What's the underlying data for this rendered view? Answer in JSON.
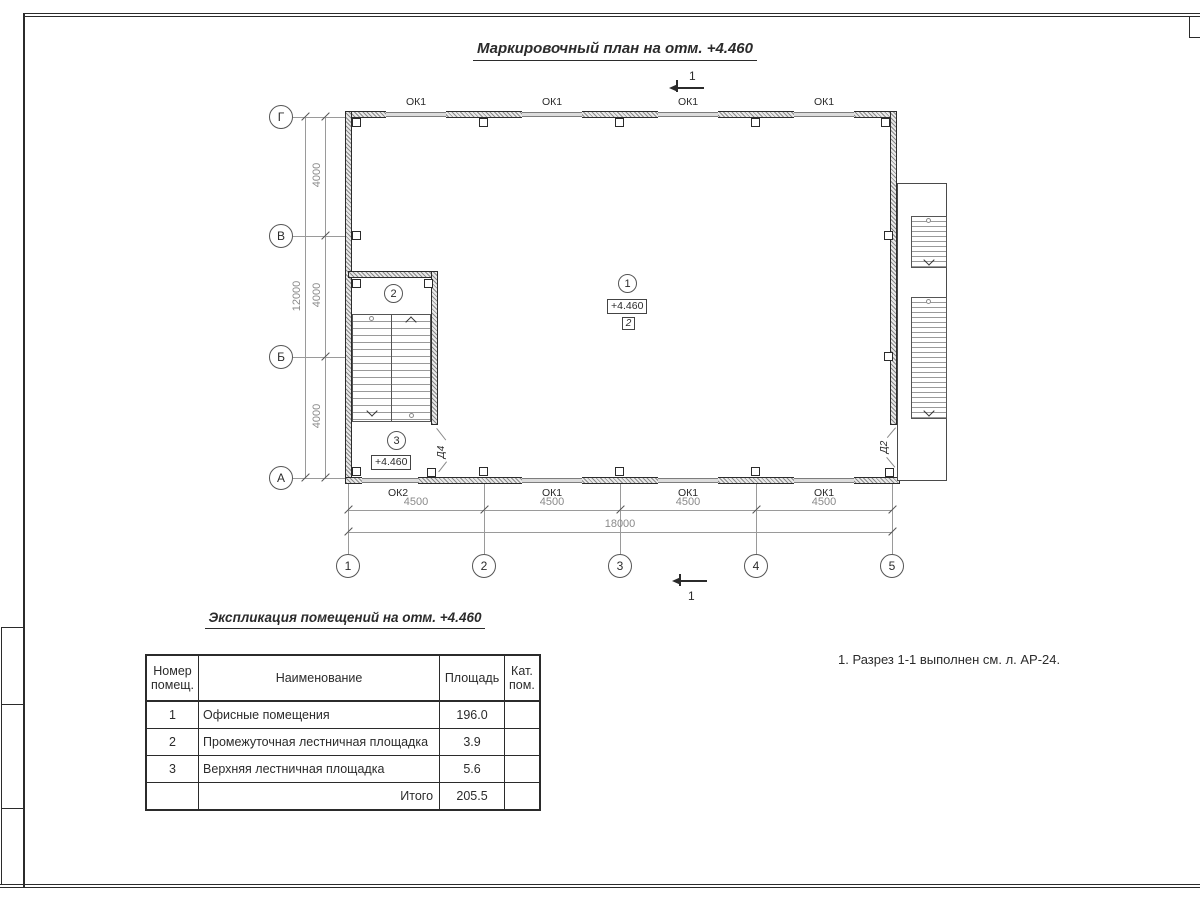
{
  "drawing": {
    "title": "Маркировочный план на отм. +4.460",
    "note": "1. Разрез 1-1 выполнен см. л. АР-24.",
    "section_mark": "1",
    "elevation_mark": "+4.460",
    "finish_mark": "2",
    "room_marks": [
      "1",
      "2",
      "3"
    ],
    "door_marks": {
      "d4": "Д4",
      "d2": "Д2"
    },
    "windows_top": [
      "ОК1",
      "ОК1",
      "ОК1",
      "ОК1"
    ],
    "windows_bottom": [
      "ОК2",
      "ОК1",
      "ОК1",
      "ОК1"
    ],
    "axes_rows": [
      "Г",
      "В",
      "Б",
      "А"
    ],
    "axes_cols": [
      "1",
      "2",
      "3",
      "4",
      "5"
    ],
    "dims_left_segments": [
      "4000",
      "4000",
      "4000"
    ],
    "dims_left_total": "12000",
    "dims_bottom_segments": [
      "4500",
      "4500",
      "4500",
      "4500"
    ],
    "dims_bottom_total": "18000"
  },
  "schedule": {
    "title": "Экспликация помещений на отм. +4.460",
    "headers": {
      "number": "Номер помещ.",
      "name": "Наименование",
      "area": "Площадь",
      "category": "Кат. пом."
    },
    "rows": [
      {
        "number": "1",
        "name": "Офисные помещения",
        "area": "196.0",
        "category": ""
      },
      {
        "number": "2",
        "name": "Промежуточная лестничная площадка",
        "area": "3.9",
        "category": ""
      },
      {
        "number": "3",
        "name": "Верхняя лестничная площадка",
        "area": "5.6",
        "category": ""
      }
    ],
    "total_label": "Итого",
    "total_value": "205.5"
  },
  "colors": {
    "ink": "#2b2b2b",
    "dim_text": "#8a8a8a",
    "window_fill": "#dcdcdc"
  }
}
